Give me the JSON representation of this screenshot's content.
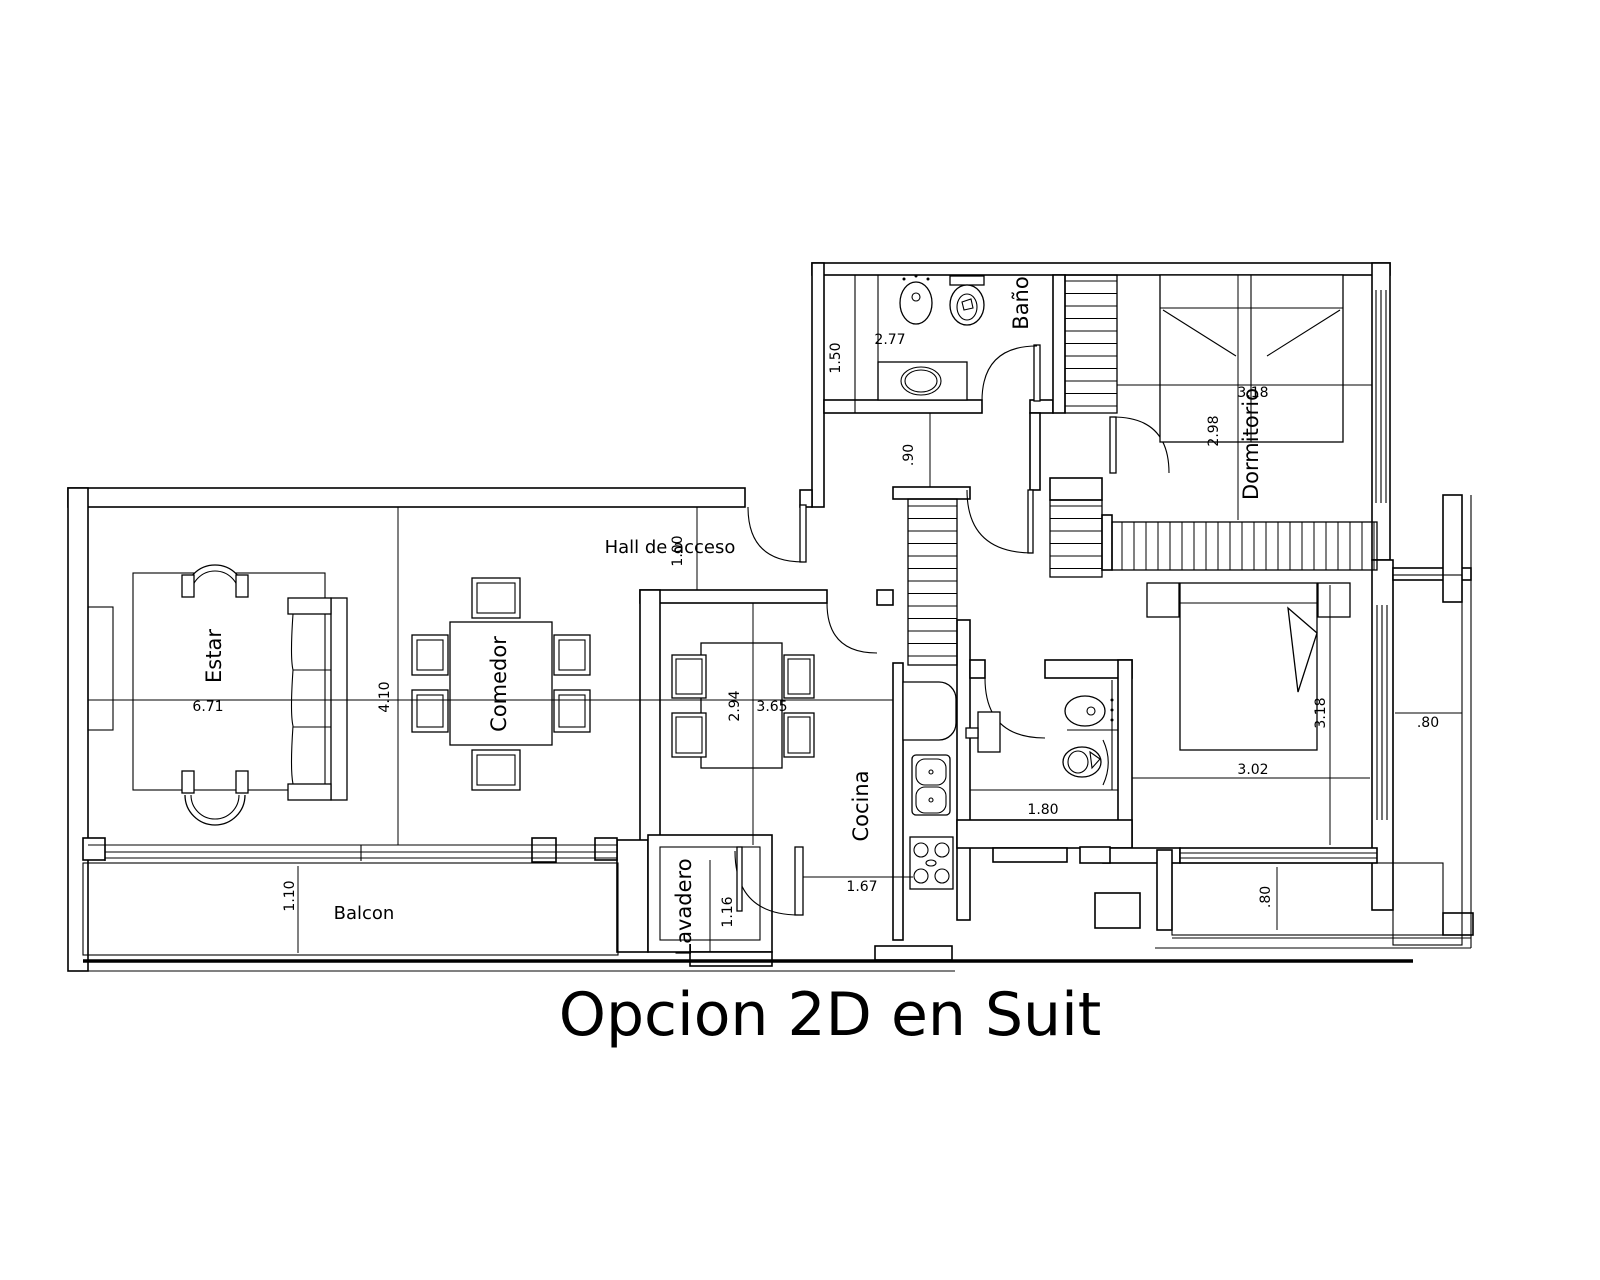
{
  "title": "Opcion 2D en Suit",
  "colors": {
    "line": "#000000",
    "background": "#ffffff"
  },
  "rooms": {
    "estar": "Estar",
    "comedor": "Comedor",
    "cocina": "Cocina",
    "lavadero": "Lavadero",
    "balcon": "Balcon",
    "hall": "Hall de acceso",
    "banio": "Baño",
    "dormitorio": "Dormitorio"
  },
  "dims": {
    "estar_width": "6.71",
    "living_depth": "4.10",
    "dinette_depth": "2.94",
    "dinette_width": "3.65",
    "hall_width": "1.00",
    "cocina_width": "1.67",
    "lavadero_width": "1.16",
    "balcon_depth": "1.10",
    "banio_depth": "1.50",
    "banio_width": "2.77",
    "pasillo_width": ".90",
    "dormitorio_width": "3.18",
    "dormitorio_depth": "2.98",
    "banio2_width": "1.80",
    "suite_width": "3.02",
    "suite_depth": "3.18",
    "balcony_right_width": ".80",
    "balcony_bottom_depth": ".80"
  }
}
